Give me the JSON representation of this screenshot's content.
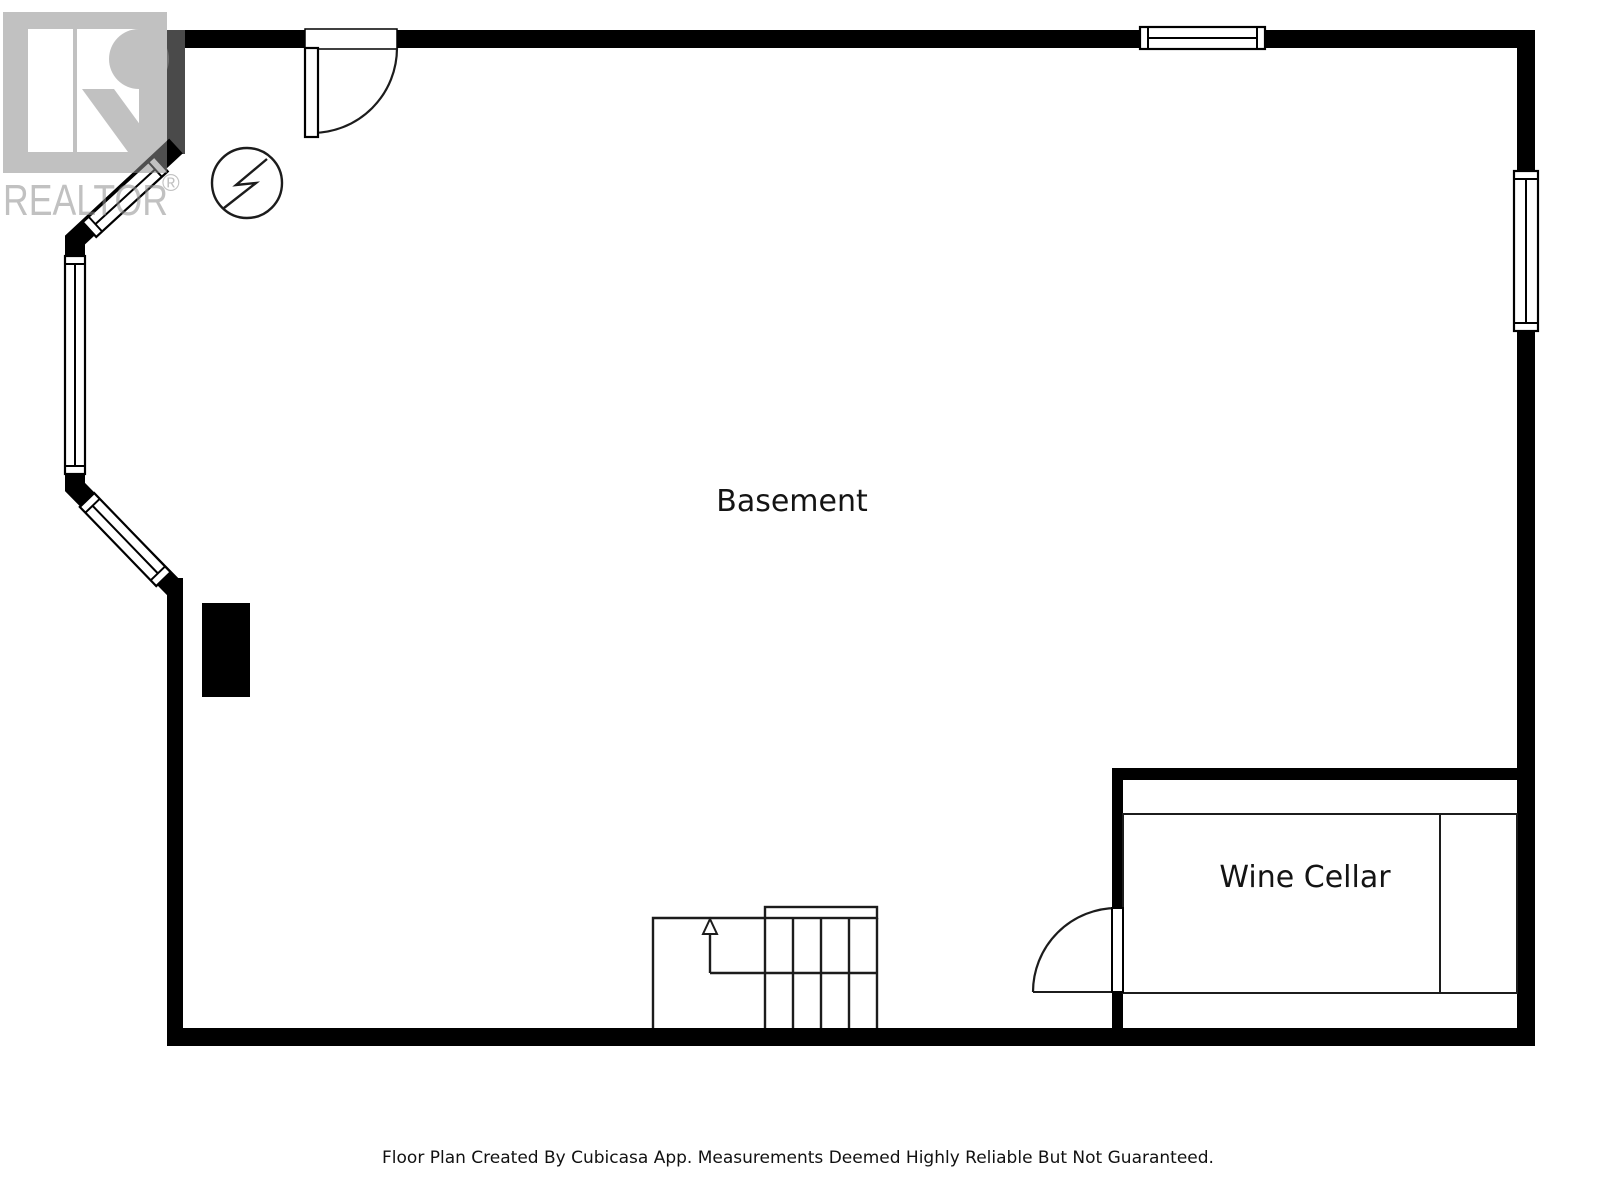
{
  "document": {
    "kind": "basement-floor-plan"
  },
  "watermark": {
    "brand": "REALTOR",
    "registered": "®"
  },
  "rooms": [
    {
      "label": "Basement"
    },
    {
      "label": "Wine Cellar"
    }
  ],
  "footer": {
    "disclaimer": "Floor Plan Created By Cubicasa App. Measurements Deemed Highly Reliable But Not Guaranteed."
  },
  "icons": {
    "electrical": "electrical-panel-symbol",
    "stair_arrow": "stairs-up-arrow",
    "doors": "door-swing-arc",
    "windows": "double-line-window"
  },
  "colors": {
    "wall": "#000000",
    "line": "#1c1c1c",
    "watermark_gray": "#909090",
    "label_text": "#141414",
    "background": "#ffffff"
  }
}
